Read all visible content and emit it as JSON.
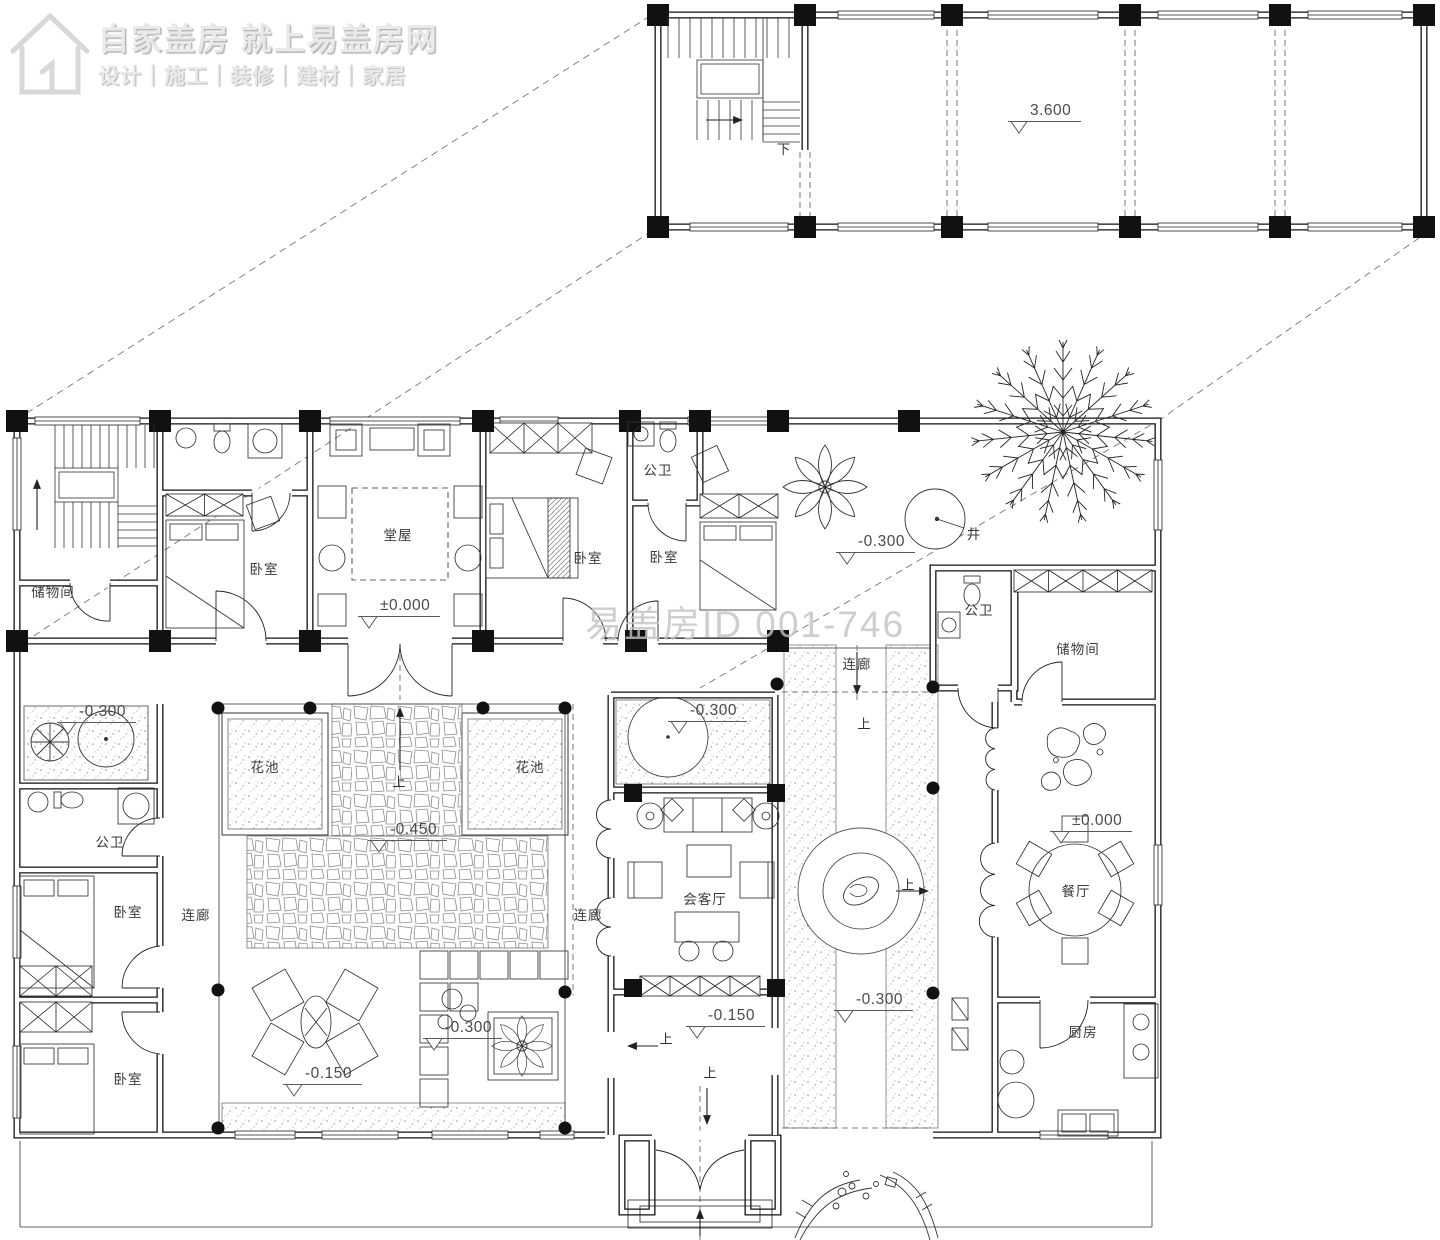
{
  "branding": {
    "title": "自家盖房 就上易盖房网",
    "subtitle": "设计｜施工｜装修｜建材｜家居"
  },
  "watermark": "易盖房ID 001-746",
  "plan": {
    "room_labels": [
      {
        "id": "storage-nw",
        "text": "储物间",
        "x": 53,
        "y": 591
      },
      {
        "id": "bedroom-nw",
        "text": "卧室",
        "x": 264,
        "y": 568
      },
      {
        "id": "main-hall",
        "text": "堂屋",
        "x": 398,
        "y": 534
      },
      {
        "id": "bedroom-n",
        "text": "卧室",
        "x": 588,
        "y": 557
      },
      {
        "id": "bath-n",
        "text": "公卫",
        "x": 658,
        "y": 469
      },
      {
        "id": "bedroom-ne",
        "text": "卧室",
        "x": 664,
        "y": 556
      },
      {
        "id": "well",
        "text": "井",
        "x": 974,
        "y": 533
      },
      {
        "id": "bath-e",
        "text": "公卫",
        "x": 979,
        "y": 609
      },
      {
        "id": "corridor-ne",
        "text": "连廊",
        "x": 857,
        "y": 663
      },
      {
        "id": "storage-e",
        "text": "储物间",
        "x": 1078,
        "y": 648
      },
      {
        "id": "dining",
        "text": "餐厅",
        "x": 1076,
        "y": 890
      },
      {
        "id": "kitchen",
        "text": "厨房",
        "x": 1083,
        "y": 1031
      },
      {
        "id": "planter-left",
        "text": "花池",
        "x": 265,
        "y": 766
      },
      {
        "id": "planter-right",
        "text": "花池",
        "x": 530,
        "y": 766
      },
      {
        "id": "bath-w",
        "text": "公卫",
        "x": 110,
        "y": 841
      },
      {
        "id": "bedroom-w1",
        "text": "卧室",
        "x": 128,
        "y": 911
      },
      {
        "id": "corridor-w",
        "text": "连廊",
        "x": 196,
        "y": 914
      },
      {
        "id": "bedroom-w2",
        "text": "卧室",
        "x": 128,
        "y": 1078
      },
      {
        "id": "corridor-center",
        "text": "连廊",
        "x": 588,
        "y": 914
      },
      {
        "id": "reception",
        "text": "会客厅",
        "x": 705,
        "y": 898
      },
      {
        "id": "stair-down",
        "text": "下",
        "x": 784,
        "y": 148
      }
    ],
    "elevation_markers": [
      {
        "value": "3.600",
        "x": 1008,
        "y": 122
      },
      {
        "value": "±0.000",
        "x": 358,
        "y": 617
      },
      {
        "value": "-0.300",
        "x": 836,
        "y": 553
      },
      {
        "value": "-0.300",
        "x": 57,
        "y": 723
      },
      {
        "value": "-0.300",
        "x": 668,
        "y": 722
      },
      {
        "value": "-0.450",
        "x": 368,
        "y": 841
      },
      {
        "value": "-0.300",
        "x": 423,
        "y": 1039
      },
      {
        "value": "-0.150",
        "x": 283,
        "y": 1085
      },
      {
        "value": "-0.150",
        "x": 686,
        "y": 1027
      },
      {
        "value": "-0.300",
        "x": 834,
        "y": 1011
      },
      {
        "value": "±0.000",
        "x": 1050,
        "y": 832
      }
    ],
    "direction_labels": [
      {
        "text": "上",
        "x": 399,
        "y": 781
      },
      {
        "text": "上",
        "x": 864,
        "y": 723
      },
      {
        "text": "上",
        "x": 908,
        "y": 884
      },
      {
        "text": "上",
        "x": 666,
        "y": 1038
      },
      {
        "text": "上",
        "x": 710,
        "y": 1072
      }
    ]
  }
}
